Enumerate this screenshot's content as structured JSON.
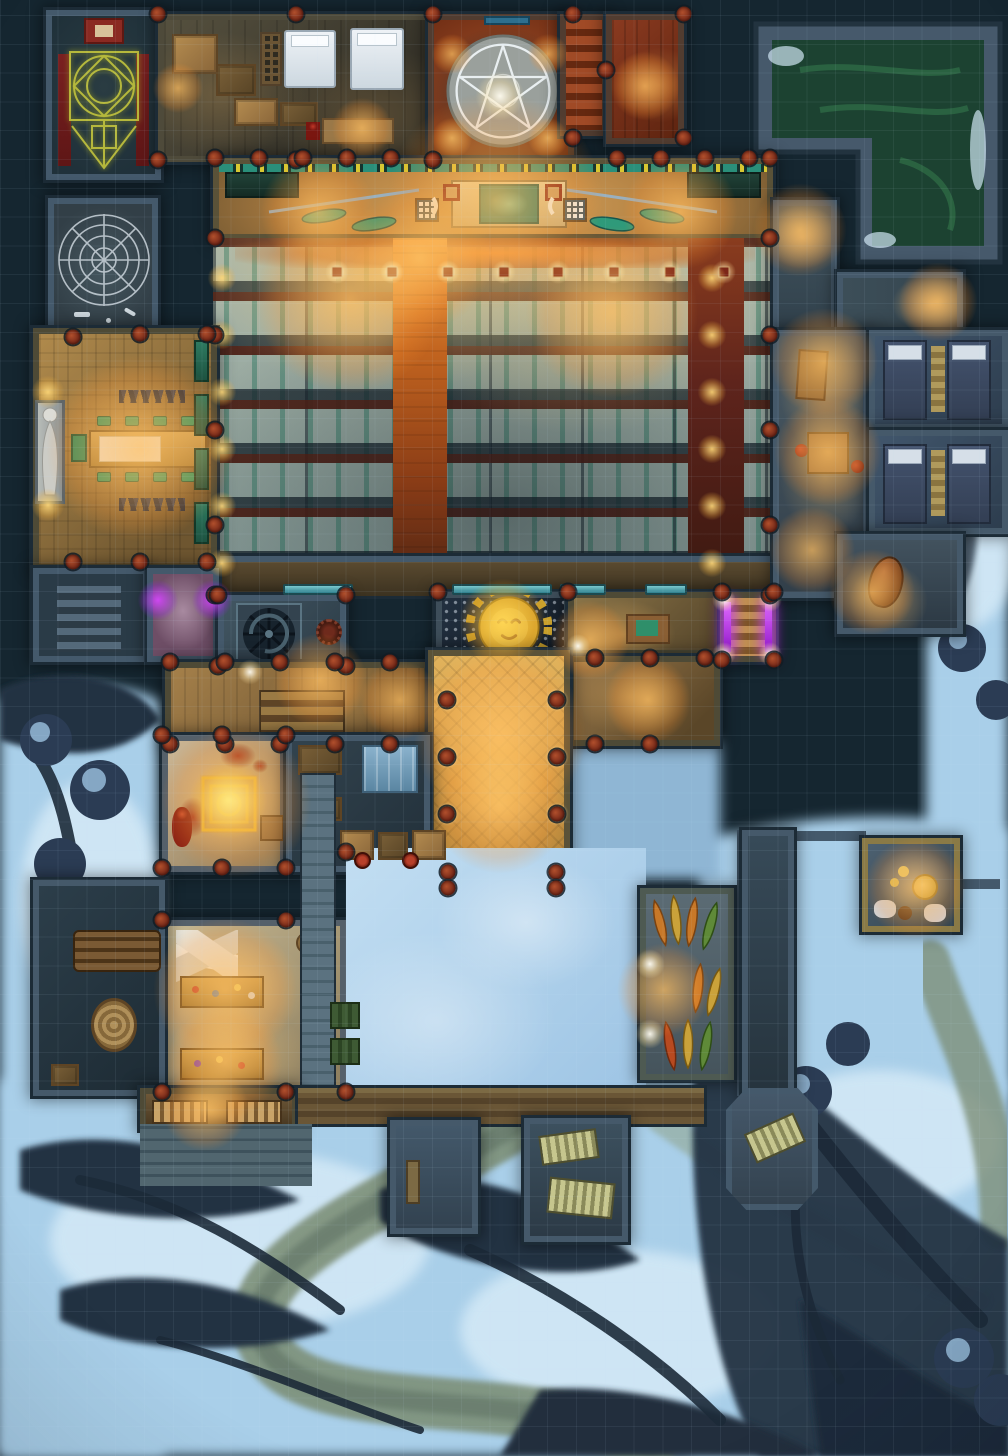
{
  "map": {
    "type": "fantasy battle map",
    "theme": "nighttime temple complex on snowy cliffs, top-down view",
    "grid": {
      "visible": true,
      "cell_px": 28.8,
      "columns": 35,
      "rows": 50
    },
    "palette": {
      "bg": "#152630",
      "wall": "#44596b",
      "wall_dark": "#1c2b36",
      "snow": "#aed3ec",
      "snow_hi": "#dceef9",
      "rock": "#233242",
      "river": "#7d8f78",
      "wood_warm": "#b98a4e",
      "wood_bright": "#d8a850",
      "carpet": "#c96a28",
      "red_floor": "#7a2d1c",
      "pool": "#1c4231",
      "teal": "#2e8f80",
      "pew_pale": "#aab7aa",
      "pew_green": "#2f8068",
      "pew_rail": "#4c1e14",
      "gold": "#d8a828",
      "sigil": "#bdbf3c",
      "purple": "#b02ae8",
      "blood": "#8a1a12"
    },
    "regions": {
      "ritual_room": "Ritual diagram chamber (glowing yellow sigil, red side carpets, shrine)",
      "web_room": "Spiderweb cellar with bones",
      "barracks": "Bedroom and crate storage",
      "pentagram_room": "Pentagram chamber with candles",
      "red_stairs": "Red stairwell",
      "red_room": "Red parquet room",
      "green_pool": "Green water pool",
      "dais": "Chapel dais with altar, banners and weapon racks",
      "nave": "Chapel nave with rows of pews",
      "aisle": "Central orange carpet aisle",
      "side_carpet": "Dark red side aisle",
      "dining_hall": "Dining hall with long table and statue",
      "purple_room": "Shrine room with purple braziers",
      "cellar_stairs": "Cellar stairs",
      "spiral_room": "Spiral staircase room",
      "sun_shrine": "Golden sun emblem shrine",
      "office": "Office with table",
      "purple_stairs": "Purple-lit stairway",
      "corridor": "South corridor with stairs",
      "east_hall": "East corridor",
      "entrance_hall": "Grand entrance hall with columns",
      "main_door": "Main double door",
      "nw_pass": "Lamplit north passage",
      "e_pass": "Lamplit east passage",
      "guard_corridor": "Guard corridor with desk and card table",
      "dorm_room_1": "Dormitory with two beds",
      "dorm_room_2": "Dormitory with two beds",
      "pot_corridor": "South passage with amphora",
      "blood_room": "Blood ritual room with glowing square sigil and corpse",
      "dark_store": "Dark storeroom with glass cabinet",
      "workshop": "Workshop with two workbenches",
      "wood_store": "Wood store with log pile and basket",
      "courtyard": "Snowy courtyard",
      "wall_walk": "Stone wall walk",
      "canoe_shed": "Canoe shed with stacked canoes",
      "pantry": "Pantry with cheese table and sacks",
      "lane": "Walled lane",
      "storeroom": "Lamplit storeroom with shelves",
      "deck": "Wooden deck",
      "stone_room": "Stone porch room",
      "bench_room": "Porch room with benches",
      "hex_porch": "Hexagonal porch with bench",
      "terrain": "Snowfield, frozen river path, dark cliffs and trees"
    },
    "icons": {
      "pentagram": "pentagram-icon",
      "sigil": "ritual-sigil-icon",
      "web": "spiderweb-icon",
      "spiral": "spiral-stair-icon",
      "sun": "sun-face-icon",
      "statue": "statue-icon",
      "canoe": "canoe-icon"
    },
    "lights": [
      [
        178,
        88,
        "o",
        70
      ],
      [
        362,
        128,
        "o",
        84
      ],
      [
        645,
        86,
        "o",
        96
      ],
      [
        452,
        54,
        "o",
        56
      ],
      [
        548,
        54,
        "o",
        56
      ],
      [
        452,
        138,
        "o",
        56
      ],
      [
        548,
        138,
        "o",
        56
      ],
      [
        500,
        96,
        "w",
        70
      ],
      [
        495,
        200,
        "o",
        300
      ],
      [
        318,
        212,
        "o",
        160
      ],
      [
        680,
        212,
        "o",
        160
      ],
      [
        337,
        272,
        "sq",
        34
      ],
      [
        392,
        272,
        "sq",
        34
      ],
      [
        448,
        272,
        "sq",
        34
      ],
      [
        504,
        272,
        "sq",
        34
      ],
      [
        558,
        272,
        "sq",
        34
      ],
      [
        614,
        272,
        "sq",
        34
      ],
      [
        670,
        272,
        "sq",
        34
      ],
      [
        724,
        272,
        "sq",
        34
      ],
      [
        350,
        300,
        "o",
        260
      ],
      [
        612,
        312,
        "o",
        240
      ],
      [
        420,
        258,
        "o",
        200
      ],
      [
        222,
        278,
        "g",
        40
      ],
      [
        222,
        335,
        "g",
        40
      ],
      [
        222,
        392,
        "g",
        40
      ],
      [
        222,
        449,
        "g",
        40
      ],
      [
        222,
        506,
        "g",
        40
      ],
      [
        222,
        563,
        "g",
        40
      ],
      [
        712,
        278,
        "g",
        40
      ],
      [
        712,
        335,
        "g",
        40
      ],
      [
        712,
        392,
        "g",
        40
      ],
      [
        712,
        449,
        "g",
        40
      ],
      [
        712,
        506,
        "g",
        40
      ],
      [
        712,
        563,
        "g",
        40
      ],
      [
        140,
        448,
        "o",
        260
      ],
      [
        48,
        392,
        "g",
        46
      ],
      [
        48,
        505,
        "g",
        46
      ],
      [
        158,
        600,
        "p",
        54
      ],
      [
        212,
        600,
        "p",
        54
      ],
      [
        503,
        622,
        "s",
        116
      ],
      [
        590,
        640,
        "o",
        110
      ],
      [
        578,
        646,
        "w",
        34
      ],
      [
        724,
        600,
        "w",
        34
      ],
      [
        770,
        600,
        "w",
        34
      ],
      [
        724,
        654,
        "w",
        34
      ],
      [
        770,
        654,
        "w",
        34
      ],
      [
        320,
        680,
        "o",
        130
      ],
      [
        250,
        672,
        "w",
        36
      ],
      [
        400,
        700,
        "o",
        110
      ],
      [
        500,
        735,
        "o",
        240
      ],
      [
        500,
        805,
        "o",
        190
      ],
      [
        447,
        700,
        "w",
        34
      ],
      [
        557,
        700,
        "w",
        34
      ],
      [
        447,
        757,
        "w",
        34
      ],
      [
        557,
        757,
        "w",
        34
      ],
      [
        447,
        814,
        "w",
        34
      ],
      [
        557,
        814,
        "w",
        34
      ],
      [
        800,
        230,
        "o",
        130
      ],
      [
        938,
        302,
        "o",
        110
      ],
      [
        824,
        362,
        "o",
        150
      ],
      [
        828,
        452,
        "o",
        150
      ],
      [
        812,
        550,
        "o",
        120
      ],
      [
        872,
        592,
        "o",
        120
      ],
      [
        228,
        800,
        "s",
        104
      ],
      [
        236,
        802,
        "o",
        210
      ],
      [
        225,
        990,
        "o",
        200
      ],
      [
        225,
        1062,
        "o",
        160
      ],
      [
        650,
        964,
        "w",
        42
      ],
      [
        650,
        1034,
        "w",
        42
      ],
      [
        664,
        990,
        "o",
        130
      ],
      [
        915,
        888,
        "o",
        140
      ],
      [
        205,
        1108,
        "o",
        120
      ],
      [
        648,
        700,
        "o",
        120
      ]
    ],
    "pillars": [
      [
        158,
        14
      ],
      [
        296,
        14
      ],
      [
        433,
        14
      ],
      [
        158,
        160
      ],
      [
        296,
        160
      ],
      [
        433,
        160
      ],
      [
        573,
        14
      ],
      [
        684,
        14
      ],
      [
        573,
        138
      ],
      [
        684,
        138
      ],
      [
        606,
        70
      ],
      [
        215,
        158
      ],
      [
        259,
        158
      ],
      [
        303,
        158
      ],
      [
        347,
        158
      ],
      [
        391,
        158
      ],
      [
        617,
        158
      ],
      [
        661,
        158
      ],
      [
        705,
        158
      ],
      [
        749,
        158
      ],
      [
        770,
        158
      ],
      [
        215,
        238
      ],
      [
        770,
        238
      ],
      [
        215,
        335
      ],
      [
        770,
        335
      ],
      [
        215,
        430
      ],
      [
        770,
        430
      ],
      [
        215,
        525
      ],
      [
        770,
        525
      ],
      [
        215,
        595
      ],
      [
        770,
        595
      ],
      [
        73,
        337
      ],
      [
        140,
        334
      ],
      [
        207,
        334
      ],
      [
        73,
        562
      ],
      [
        140,
        562
      ],
      [
        207,
        562
      ],
      [
        218,
        595
      ],
      [
        346,
        595
      ],
      [
        218,
        666
      ],
      [
        346,
        666
      ],
      [
        438,
        592
      ],
      [
        568,
        592
      ],
      [
        170,
        662
      ],
      [
        225,
        662
      ],
      [
        280,
        662
      ],
      [
        335,
        662
      ],
      [
        390,
        662
      ],
      [
        170,
        744
      ],
      [
        225,
        744
      ],
      [
        280,
        744
      ],
      [
        335,
        744
      ],
      [
        390,
        744
      ],
      [
        595,
        658
      ],
      [
        650,
        658
      ],
      [
        705,
        658
      ],
      [
        595,
        744
      ],
      [
        650,
        744
      ],
      [
        447,
        700
      ],
      [
        557,
        700
      ],
      [
        447,
        757
      ],
      [
        557,
        757
      ],
      [
        447,
        814
      ],
      [
        557,
        814
      ],
      [
        448,
        872
      ],
      [
        556,
        872
      ],
      [
        448,
        888
      ],
      [
        556,
        888
      ],
      [
        162,
        735
      ],
      [
        222,
        735
      ],
      [
        286,
        735
      ],
      [
        162,
        868
      ],
      [
        222,
        868
      ],
      [
        286,
        868
      ],
      [
        162,
        920
      ],
      [
        286,
        920
      ],
      [
        162,
        1092
      ],
      [
        286,
        1092
      ],
      [
        346,
        852
      ],
      [
        346,
        1092
      ],
      [
        722,
        592
      ],
      [
        774,
        592
      ],
      [
        722,
        660
      ],
      [
        774,
        660
      ]
    ]
  }
}
